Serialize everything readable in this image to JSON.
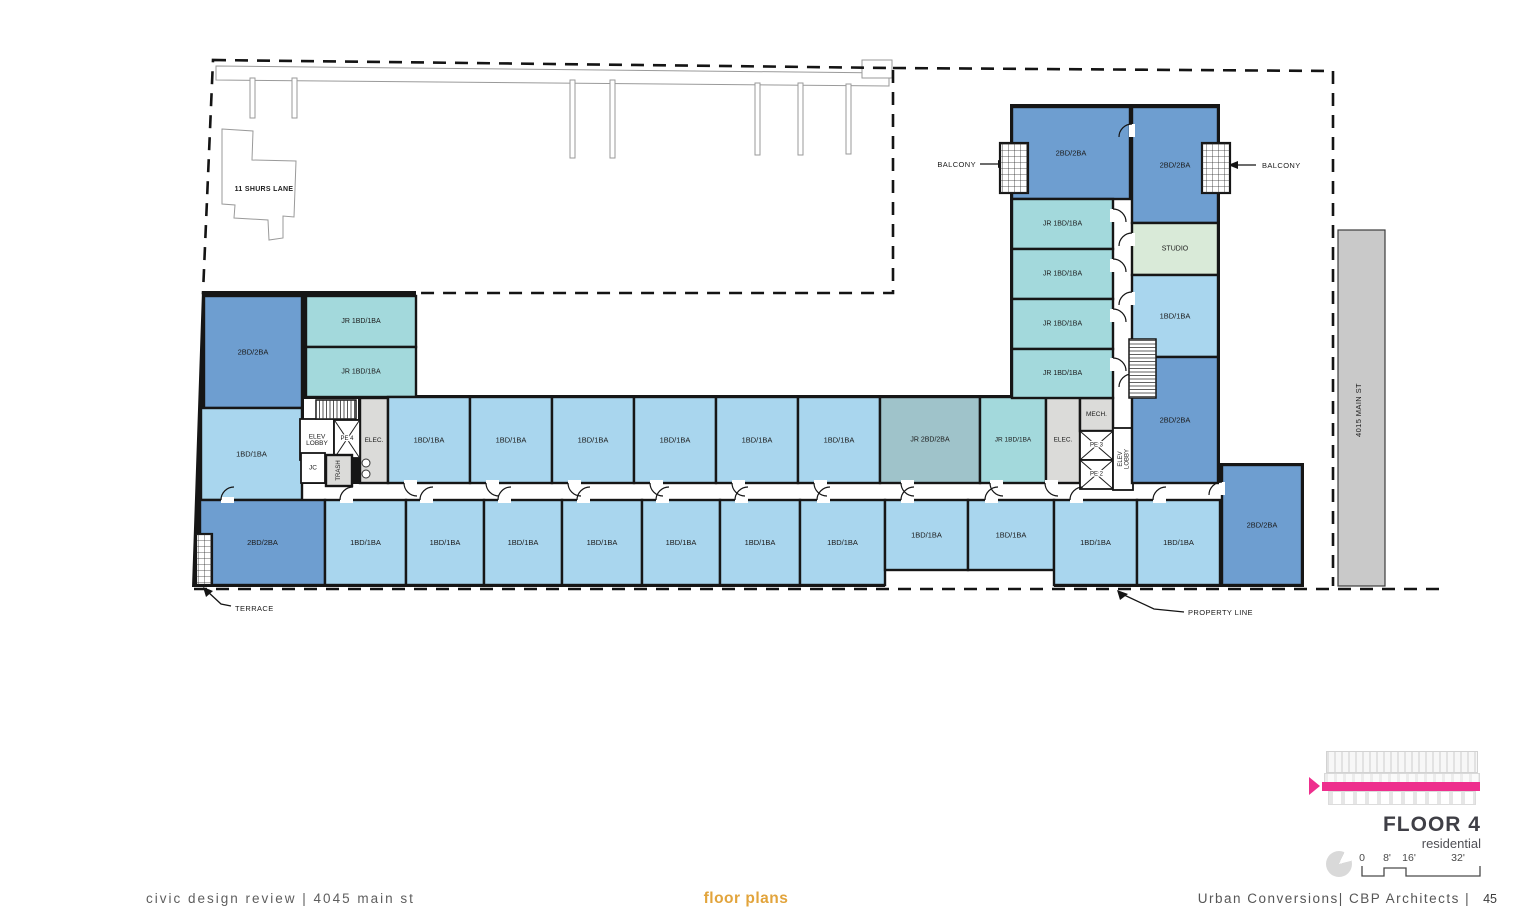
{
  "page": {
    "footer_left": "civic design review | 4045 main st",
    "footer_center": "floor plans",
    "footer_right": "Urban Conversions| CBP Architects |",
    "page_number": "45"
  },
  "title_block": {
    "title": "FLOOR 4",
    "subtitle": "residential",
    "scale_ticks": [
      "0",
      "8'",
      "16'",
      "32'"
    ]
  },
  "annotations": {
    "balcony_left": "BALCONY",
    "balcony_right": "BALCONY",
    "terrace": "TERRACE",
    "property_line": "PROPERTY LINE",
    "neighbor_building": "11 SHURS LANE",
    "main_st_building": "4015 MAIN ST"
  },
  "floor_plan": {
    "palette": {
      "2bd": "#6e9ed0",
      "1bd": "#a9d6ee",
      "jr1": "#a3d9dc",
      "jr2": "#9fc3ca",
      "studio": "#d9ead8",
      "svc": "#dbdbd9",
      "wht": "#ffffff",
      "wall": "#161616"
    },
    "shell": "202,291 416,291 416,395 1010,395 1010,104 1220,104 1220,463 1304,463 1304,587 1054,587 1054,570 885,570 885,587 192,587",
    "corridors": [
      [
        303,
        484,
        919,
        16
      ],
      [
        1113,
        198,
        20,
        290
      ],
      [
        304,
        399,
        54,
        20
      ]
    ],
    "rooms": [
      {
        "label": "2BD/2BA",
        "x": 204,
        "y": 296,
        "w": 98,
        "h": 112,
        "c": "2bd"
      },
      {
        "label": "1BD/1BA",
        "x": 201,
        "y": 408,
        "w": 101,
        "h": 92,
        "c": "1bd"
      },
      {
        "label": "JR 1BD/1BA",
        "x": 306,
        "y": 296,
        "w": 110,
        "h": 51,
        "c": "jr1",
        "fs": 7
      },
      {
        "label": "JR 1BD/1BA",
        "x": 306,
        "y": 347,
        "w": 110,
        "h": 50,
        "c": "jr1",
        "fs": 7
      },
      {
        "label": "ELEC.",
        "x": 360,
        "y": 398,
        "w": 28,
        "h": 85,
        "c": "svc",
        "fs": 6.5
      },
      {
        "label": "ELEV\nLOBBY",
        "x": 300,
        "y": 419,
        "w": 34,
        "h": 41,
        "c": "wht",
        "fs": 6.5
      },
      {
        "label": "PE 4",
        "x": 334,
        "y": 420,
        "w": 26,
        "h": 38,
        "c": "wht",
        "fs": 6,
        "kind": "elev"
      },
      {
        "label": "JC",
        "x": 301,
        "y": 453,
        "w": 24,
        "h": 30,
        "c": "wht",
        "fs": 6.5
      },
      {
        "label": "TRASH",
        "x": 326,
        "y": 455,
        "w": 26,
        "h": 31,
        "c": "svc",
        "fs": 6,
        "rot": -90
      },
      {
        "label": "1BD/1BA",
        "x": 388,
        "y": 397,
        "w": 82,
        "h": 86,
        "c": "1bd",
        "door": "s"
      },
      {
        "label": "1BD/1BA",
        "x": 470,
        "y": 397,
        "w": 82,
        "h": 86,
        "c": "1bd",
        "door": "s"
      },
      {
        "label": "1BD/1BA",
        "x": 552,
        "y": 397,
        "w": 82,
        "h": 86,
        "c": "1bd",
        "door": "s"
      },
      {
        "label": "1BD/1BA",
        "x": 634,
        "y": 397,
        "w": 82,
        "h": 86,
        "c": "1bd",
        "door": "s"
      },
      {
        "label": "1BD/1BA",
        "x": 716,
        "y": 397,
        "w": 82,
        "h": 86,
        "c": "1bd",
        "door": "s"
      },
      {
        "label": "1BD/1BA",
        "x": 798,
        "y": 397,
        "w": 82,
        "h": 86,
        "c": "1bd",
        "door": "s"
      },
      {
        "label": "JR 2BD/2BA",
        "x": 880,
        "y": 397,
        "w": 100,
        "h": 86,
        "c": "jr2",
        "fs": 7,
        "door": "s"
      },
      {
        "label": "JR 1BD/1BA",
        "x": 980,
        "y": 397,
        "w": 66,
        "h": 86,
        "c": "jr1",
        "fs": 6.5,
        "door": "s"
      },
      {
        "label": "ELEC.",
        "x": 1046,
        "y": 397,
        "w": 34,
        "h": 86,
        "c": "svc",
        "fs": 6.5,
        "door": "s"
      },
      {
        "label": "MECH.",
        "x": 1080,
        "y": 398,
        "w": 33,
        "h": 33,
        "c": "svc",
        "fs": 6.5
      },
      {
        "label": "PE 3",
        "x": 1080,
        "y": 431,
        "w": 33,
        "h": 29,
        "c": "wht",
        "fs": 6,
        "kind": "elev"
      },
      {
        "label": "PE 2",
        "x": 1080,
        "y": 460,
        "w": 33,
        "h": 29,
        "c": "wht",
        "fs": 6,
        "kind": "elev"
      },
      {
        "label": "ELEV\nLOBBY",
        "x": 1113,
        "y": 428,
        "w": 20,
        "h": 62,
        "c": "wht",
        "fs": 6,
        "rot": -90
      },
      {
        "label": "2BD/2BA",
        "x": 1012,
        "y": 107,
        "w": 118,
        "h": 92,
        "c": "2bd"
      },
      {
        "label": "2BD/2BA",
        "x": 1132,
        "y": 107,
        "w": 86,
        "h": 116,
        "c": "2bd",
        "door": "w"
      },
      {
        "label": "JR 1BD/1BA",
        "x": 1012,
        "y": 199,
        "w": 101,
        "h": 50,
        "c": "jr1",
        "fs": 7,
        "door": "e"
      },
      {
        "label": "JR 1BD/1BA",
        "x": 1012,
        "y": 249,
        "w": 101,
        "h": 50,
        "c": "jr1",
        "fs": 7,
        "door": "e"
      },
      {
        "label": "JR 1BD/1BA",
        "x": 1012,
        "y": 299,
        "w": 101,
        "h": 50,
        "c": "jr1",
        "fs": 7,
        "door": "e"
      },
      {
        "label": "JR 1BD/1BA",
        "x": 1012,
        "y": 349,
        "w": 101,
        "h": 49,
        "c": "jr1",
        "fs": 7,
        "door": "e"
      },
      {
        "label": "STUDIO",
        "x": 1132,
        "y": 223,
        "w": 86,
        "h": 52,
        "c": "studio",
        "fs": 7,
        "door": "w"
      },
      {
        "label": "1BD/1BA",
        "x": 1132,
        "y": 275,
        "w": 86,
        "h": 82,
        "c": "1bd",
        "door": "w"
      },
      {
        "label": "2BD/2BA",
        "x": 1132,
        "y": 357,
        "w": 86,
        "h": 126,
        "c": "2bd",
        "door": "w"
      },
      {
        "label": "2BD/2BA",
        "x": 200,
        "y": 500,
        "w": 125,
        "h": 85,
        "c": "2bd",
        "door": "n"
      },
      {
        "label": "1BD/1BA",
        "x": 325,
        "y": 500,
        "w": 81,
        "h": 85,
        "c": "1bd",
        "door": "n"
      },
      {
        "label": "1BD/1BA",
        "x": 406,
        "y": 500,
        "w": 78,
        "h": 85,
        "c": "1bd",
        "door": "n"
      },
      {
        "label": "1BD/1BA",
        "x": 484,
        "y": 500,
        "w": 78,
        "h": 85,
        "c": "1bd",
        "door": "n"
      },
      {
        "label": "1BD/1BA",
        "x": 562,
        "y": 500,
        "w": 80,
        "h": 85,
        "c": "1bd",
        "door": "n"
      },
      {
        "label": "1BD/1BA",
        "x": 642,
        "y": 500,
        "w": 78,
        "h": 85,
        "c": "1bd",
        "door": "n"
      },
      {
        "label": "1BD/1BA",
        "x": 720,
        "y": 500,
        "w": 80,
        "h": 85,
        "c": "1bd",
        "door": "n"
      },
      {
        "label": "1BD/1BA",
        "x": 800,
        "y": 500,
        "w": 85,
        "h": 85,
        "c": "1bd",
        "door": "n"
      },
      {
        "label": "1BD/1BA",
        "x": 885,
        "y": 500,
        "w": 83,
        "h": 70,
        "c": "1bd",
        "door": "n"
      },
      {
        "label": "1BD/1BA",
        "x": 968,
        "y": 500,
        "w": 86,
        "h": 70,
        "c": "1bd",
        "door": "n"
      },
      {
        "label": "1BD/1BA",
        "x": 1054,
        "y": 500,
        "w": 83,
        "h": 85,
        "c": "1bd",
        "door": "n"
      },
      {
        "label": "1BD/1BA",
        "x": 1137,
        "y": 500,
        "w": 83,
        "h": 85,
        "c": "1bd",
        "door": "n"
      },
      {
        "label": "2BD/2BA",
        "x": 1222,
        "y": 465,
        "w": 80,
        "h": 120,
        "c": "2bd",
        "door": "w"
      }
    ],
    "stairs": [
      [
        316,
        400,
        40,
        19,
        "pv"
      ],
      [
        1129,
        339,
        27,
        59,
        "ph"
      ]
    ],
    "hatches": [
      [
        1000,
        143,
        28,
        50
      ],
      [
        1202,
        143,
        28,
        50
      ],
      [
        196,
        534,
        16,
        51
      ]
    ],
    "washers": [
      [
        366,
        463
      ],
      [
        366,
        474
      ]
    ]
  }
}
